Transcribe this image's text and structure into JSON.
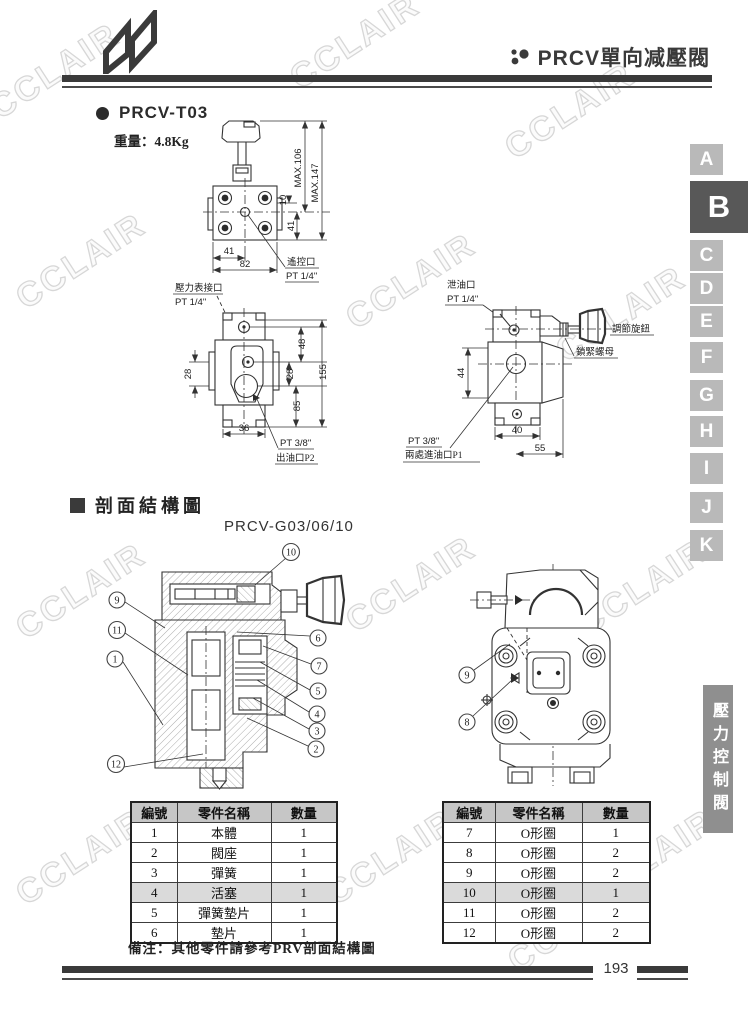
{
  "header": {
    "title": "PRCV單向减壓閥"
  },
  "section_t03": {
    "title": "PRCV-T03",
    "weight": "重量：4.8Kg"
  },
  "top_view": {
    "max106": "MAX.106",
    "max147": "MAX.147",
    "d10": "10",
    "d41_side": "41",
    "d41_bottom": "41",
    "d82": "82",
    "remote_port_line1": "遙控口",
    "remote_port_line2": "PT 1/4\""
  },
  "front_view": {
    "gauge_line1": "壓力表接口",
    "gauge_line2": "PT 1/4\"",
    "d28_left": "28",
    "d48": "48",
    "d28_right": "28",
    "d155": "155",
    "d85": "85",
    "d36": "36",
    "outlet_line1": "PT 3/8\"",
    "outlet_line2": "出油口P2"
  },
  "side_view": {
    "drain_line1": "泄油口",
    "drain_line2": "PT 1/4\"",
    "knob_label": "調節旋鈕",
    "locknut_label": "鎖緊螺母",
    "d44": "44",
    "d40": "40",
    "d55": "55",
    "inlet_line1": "PT 3/8\"",
    "inlet_line2": "兩處進油口P1"
  },
  "section_structure": {
    "title": "剖面結構圖",
    "model": "PRCV-G03/06/10"
  },
  "cutaway": {
    "left_callouts": [
      "10",
      "9",
      "11",
      "1",
      "12",
      "6",
      "7",
      "5",
      "4",
      "3",
      "2"
    ],
    "right_callouts": [
      "9",
      "8"
    ]
  },
  "parts_table": {
    "headers": [
      "編號",
      "零件名稱",
      "數量"
    ],
    "left": [
      [
        "1",
        "本體",
        "1"
      ],
      [
        "2",
        "閥座",
        "1"
      ],
      [
        "3",
        "彈簧",
        "1"
      ],
      [
        "4",
        "活塞",
        "1"
      ],
      [
        "5",
        "彈簧墊片",
        "1"
      ],
      [
        "6",
        "墊片",
        "1"
      ]
    ],
    "right": [
      [
        "7",
        "O形圈",
        "1"
      ],
      [
        "8",
        "O形圈",
        "2"
      ],
      [
        "9",
        "O形圈",
        "2"
      ],
      [
        "10",
        "O形圈",
        "1"
      ],
      [
        "11",
        "O形圈",
        "2"
      ],
      [
        "12",
        "O形圈",
        "2"
      ]
    ]
  },
  "note": "備注：其他零件請參考PRV剖面結構圖",
  "index_tabs": {
    "letters": [
      "A",
      "B",
      "C",
      "D",
      "E",
      "F",
      "G",
      "H",
      "I",
      "J",
      "K"
    ],
    "active": "B"
  },
  "category_tab": "壓力控制閥",
  "footer": {
    "page": "193"
  },
  "watermark": {
    "text": "CCLAIR"
  },
  "colors": {
    "tab_inactive": "#b9b9b9",
    "tab_active": "#585858",
    "category_bg": "#8f8f8f",
    "rule": "#3a3a3a"
  }
}
